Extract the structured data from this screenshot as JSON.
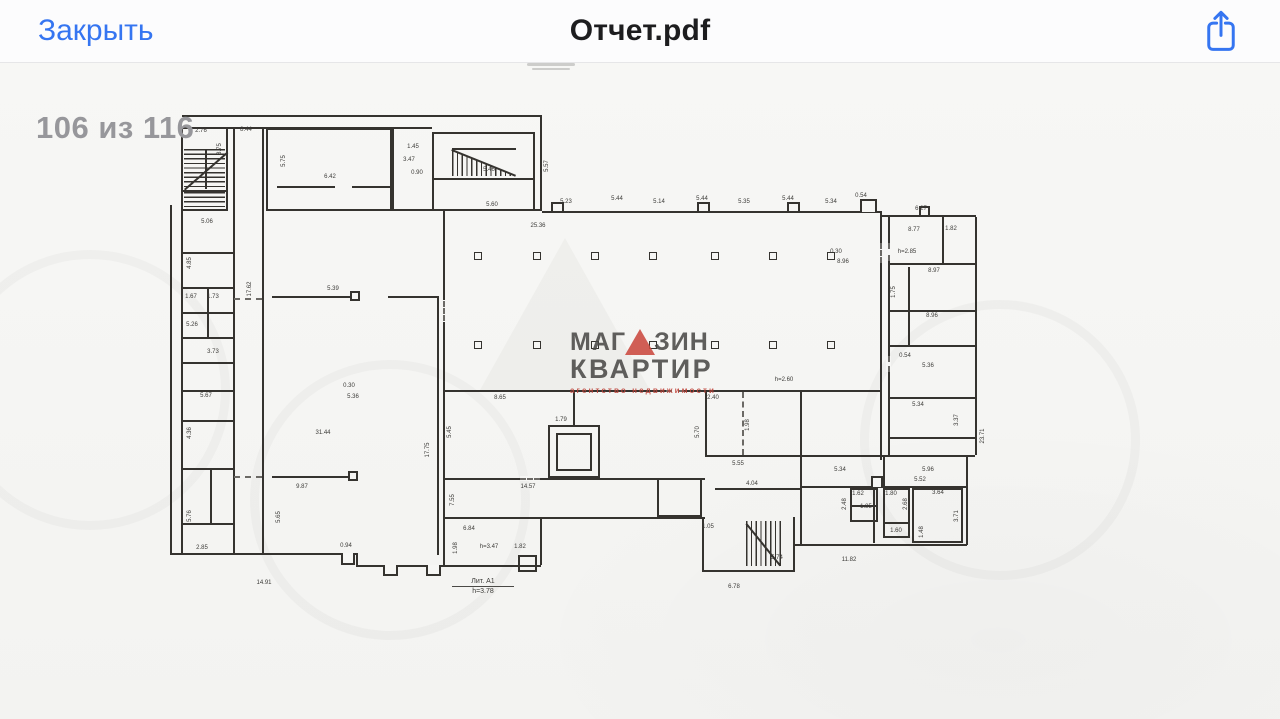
{
  "navbar": {
    "close_label": "Закрыть",
    "title": "Отчет.pdf"
  },
  "page_indicator": "106 из 116",
  "colors": {
    "accent_blue": "#3575f1",
    "title_dark": "#1d1d1f",
    "indicator_gray": "#97979b",
    "plan_line": "#35332f",
    "logo_red": "#cc4a40",
    "logo_dark": "#4b4a48"
  },
  "watermark_logo": {
    "line1_left": "МАГ",
    "line1_right": "ЗИН",
    "line2": "КВАРТИР",
    "line3": "агентство недвижимости"
  },
  "plan_labels": {
    "lit_name": "Лит. А1",
    "lit_height": "h=3.78"
  },
  "annotations": [
    {
      "t": "5.60",
      "x": 492,
      "y": 205
    },
    {
      "t": "5.23",
      "x": 566,
      "y": 202
    },
    {
      "t": "5.44",
      "x": 617,
      "y": 199
    },
    {
      "t": "5.14",
      "x": 659,
      "y": 202
    },
    {
      "t": "5.44",
      "x": 702,
      "y": 199
    },
    {
      "t": "5.35",
      "x": 744,
      "y": 202
    },
    {
      "t": "5.44",
      "x": 788,
      "y": 199
    },
    {
      "t": "5.34",
      "x": 831,
      "y": 202
    },
    {
      "t": "0.54",
      "x": 861,
      "y": 196
    },
    {
      "t": "6.27",
      "x": 921,
      "y": 209
    },
    {
      "t": "25.36",
      "x": 538,
      "y": 226
    },
    {
      "t": "2.76",
      "x": 201,
      "y": 131
    },
    {
      "t": "3.75",
      "x": 220,
      "y": 149,
      "v": true
    },
    {
      "t": "8.44",
      "x": 246,
      "y": 130
    },
    {
      "t": "5.75",
      "x": 284,
      "y": 161,
      "v": true
    },
    {
      "t": "6.42",
      "x": 330,
      "y": 177
    },
    {
      "t": "1.45",
      "x": 413,
      "y": 147
    },
    {
      "t": "3.47",
      "x": 409,
      "y": 160
    },
    {
      "t": "0.90",
      "x": 417,
      "y": 173
    },
    {
      "t": "5.46",
      "x": 489,
      "y": 170
    },
    {
      "t": "5.57",
      "x": 547,
      "y": 166,
      "v": true
    },
    {
      "t": "5.39",
      "x": 333,
      "y": 289
    },
    {
      "t": "5.06",
      "x": 207,
      "y": 222
    },
    {
      "t": "4.85",
      "x": 190,
      "y": 263,
      "v": true
    },
    {
      "t": "1.67",
      "x": 191,
      "y": 297
    },
    {
      "t": "1.73",
      "x": 213,
      "y": 297
    },
    {
      "t": "5.26",
      "x": 192,
      "y": 325
    },
    {
      "t": "3.73",
      "x": 213,
      "y": 352
    },
    {
      "t": "5.67",
      "x": 206,
      "y": 396
    },
    {
      "t": "4.36",
      "x": 190,
      "y": 433,
      "v": true
    },
    {
      "t": "5.76",
      "x": 190,
      "y": 516,
      "v": true
    },
    {
      "t": "2.85",
      "x": 202,
      "y": 548
    },
    {
      "t": "17.62",
      "x": 250,
      "y": 289,
      "v": true
    },
    {
      "t": "31.44",
      "x": 323,
      "y": 433
    },
    {
      "t": "0.30",
      "x": 349,
      "y": 386
    },
    {
      "t": "5.36",
      "x": 353,
      "y": 397
    },
    {
      "t": "9.87",
      "x": 302,
      "y": 487
    },
    {
      "t": "5.65",
      "x": 279,
      "y": 517,
      "v": true
    },
    {
      "t": "0.94",
      "x": 346,
      "y": 546
    },
    {
      "t": "14.91",
      "x": 264,
      "y": 583
    },
    {
      "t": "17.75",
      "x": 428,
      "y": 450,
      "v": true
    },
    {
      "t": "5.45",
      "x": 450,
      "y": 432,
      "v": true
    },
    {
      "t": "7.55",
      "x": 453,
      "y": 500,
      "v": true
    },
    {
      "t": "1.98",
      "x": 456,
      "y": 548,
      "v": true
    },
    {
      "t": "8.65",
      "x": 500,
      "y": 398
    },
    {
      "t": "1.79",
      "x": 561,
      "y": 420
    },
    {
      "t": "14.57",
      "x": 528,
      "y": 487
    },
    {
      "t": "6.84",
      "x": 469,
      "y": 529
    },
    {
      "t": "h=3.47",
      "x": 489,
      "y": 547
    },
    {
      "t": "1.82",
      "x": 520,
      "y": 547
    },
    {
      "t": "2.40",
      "x": 713,
      "y": 398
    },
    {
      "t": "1.98",
      "x": 748,
      "y": 425,
      "v": true
    },
    {
      "t": "5.70",
      "x": 698,
      "y": 432,
      "v": true
    },
    {
      "t": "5.55",
      "x": 738,
      "y": 464
    },
    {
      "t": "4.04",
      "x": 752,
      "y": 484
    },
    {
      "t": "1.05",
      "x": 708,
      "y": 527
    },
    {
      "t": "5.74",
      "x": 777,
      "y": 558
    },
    {
      "t": "6.78",
      "x": 734,
      "y": 587
    },
    {
      "t": "11.82",
      "x": 849,
      "y": 560
    },
    {
      "t": "5.34",
      "x": 840,
      "y": 470
    },
    {
      "t": "5.96",
      "x": 928,
      "y": 470
    },
    {
      "t": "5.52",
      "x": 920,
      "y": 480
    },
    {
      "t": "3.64",
      "x": 938,
      "y": 493
    },
    {
      "t": "1.62",
      "x": 858,
      "y": 494
    },
    {
      "t": "1.85",
      "x": 866,
      "y": 507
    },
    {
      "t": "2.48",
      "x": 845,
      "y": 504,
      "v": true
    },
    {
      "t": "1.80",
      "x": 891,
      "y": 494
    },
    {
      "t": "2.68",
      "x": 906,
      "y": 504,
      "v": true
    },
    {
      "t": "1.60",
      "x": 896,
      "y": 531
    },
    {
      "t": "1.48",
      "x": 922,
      "y": 532,
      "v": true
    },
    {
      "t": "3.71",
      "x": 957,
      "y": 516,
      "v": true
    },
    {
      "t": "8.77",
      "x": 914,
      "y": 230
    },
    {
      "t": "1.82",
      "x": 951,
      "y": 229
    },
    {
      "t": "h=2.85",
      "x": 907,
      "y": 252
    },
    {
      "t": "8.97",
      "x": 934,
      "y": 271
    },
    {
      "t": "1.75",
      "x": 894,
      "y": 292,
      "v": true
    },
    {
      "t": "8.96",
      "x": 932,
      "y": 316
    },
    {
      "t": "0.54",
      "x": 905,
      "y": 356
    },
    {
      "t": "5.36",
      "x": 928,
      "y": 366
    },
    {
      "t": "5.34",
      "x": 918,
      "y": 405
    },
    {
      "t": "3.37",
      "x": 957,
      "y": 420,
      "v": true
    },
    {
      "t": "23.71",
      "x": 983,
      "y": 436,
      "v": true
    },
    {
      "t": "h=2.60",
      "x": 784,
      "y": 380
    },
    {
      "t": "8.96",
      "x": 843,
      "y": 262
    },
    {
      "t": "0.30",
      "x": 836,
      "y": 252
    }
  ]
}
